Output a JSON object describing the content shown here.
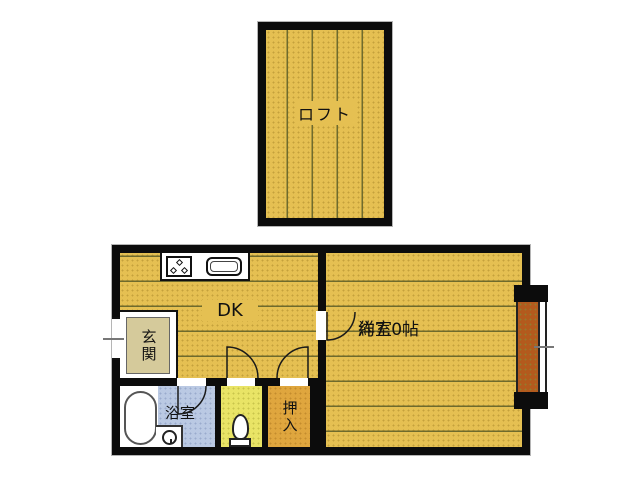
{
  "floor_plan": {
    "loft": {
      "label": "ロフト"
    },
    "main": {
      "dk_label": "DK",
      "western_label": "洋室",
      "western_area": "約7.0帖",
      "entrance_label": "玄関",
      "bathroom_label": "浴室",
      "closet_label": "押入"
    },
    "colors": {
      "wall": "#0c0c0c",
      "flooring": "#e5c052",
      "flooring_line": "#6e6b2e",
      "closet_fill": "#dfa63e",
      "toilet_room_fill": "#e9e466",
      "bathroom_fill": "#bac9e3",
      "entrance_mat_fill": "#d5ca9b",
      "bay_shelf_fill": "#b35a1d"
    },
    "fixtures": {
      "stove": "stove-icon",
      "sink": "sink-icon",
      "bathtub": "bathtub-icon",
      "toilet": "toilet-icon",
      "washer_drain": "drain-icon",
      "bay_window": "bay-window",
      "entry_door": "entry-door",
      "door_swings": "door-swing-arc"
    }
  }
}
